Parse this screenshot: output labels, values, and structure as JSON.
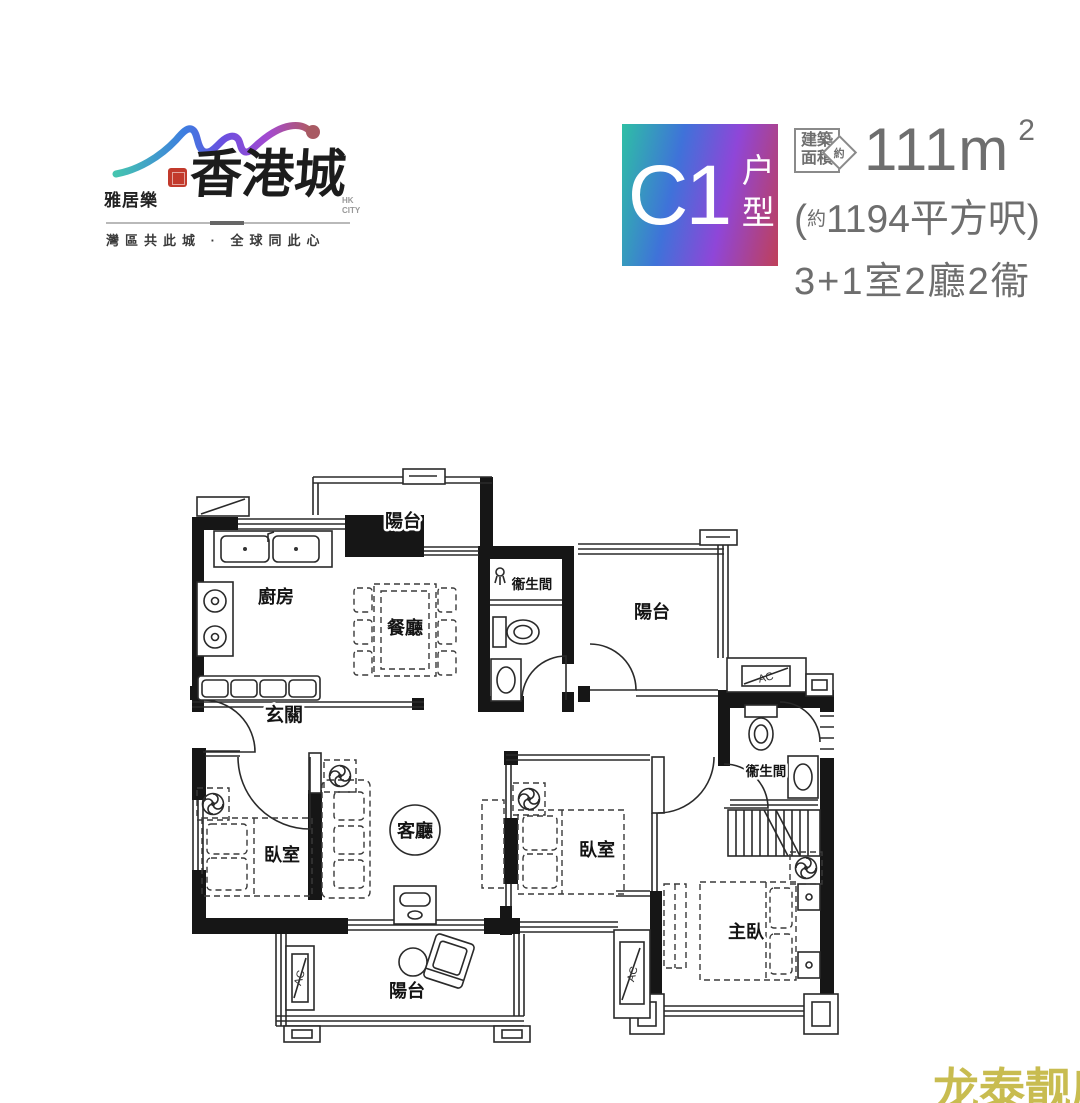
{
  "logo": {
    "brand": "雅居樂",
    "name": "香港城",
    "sub": "HK CITY",
    "tagline": "灣區共此城 · 全球同此心"
  },
  "unit": {
    "code": "C1",
    "type_label": "户型",
    "area_box_line1": "建築",
    "area_box_line2": "面積",
    "area_approx": "約",
    "area_value": "111m",
    "area_sup": "2",
    "sqft_open": "(",
    "sqft_approx": "約",
    "sqft_main": "1194平方呎)",
    "layout": "3+1室2廳2衞"
  },
  "floorplan": {
    "ac_label": "AC",
    "rooms": [
      {
        "id": "balcony-top",
        "label": "陽台"
      },
      {
        "id": "kitchen",
        "label": "廚房"
      },
      {
        "id": "dining",
        "label": "餐廳"
      },
      {
        "id": "bathroom-1",
        "label": "衞生間"
      },
      {
        "id": "balcony-right",
        "label": "陽台"
      },
      {
        "id": "entry",
        "label": "玄關"
      },
      {
        "id": "bedroom-left",
        "label": "臥室"
      },
      {
        "id": "living",
        "label": "客廳"
      },
      {
        "id": "bedroom-middle",
        "label": "臥室"
      },
      {
        "id": "bathroom-2",
        "label": "衞生間"
      },
      {
        "id": "master-bedroom",
        "label": "主臥"
      },
      {
        "id": "balcony-bottom",
        "label": "陽台"
      }
    ]
  },
  "watermark": "龙泰靓房"
}
